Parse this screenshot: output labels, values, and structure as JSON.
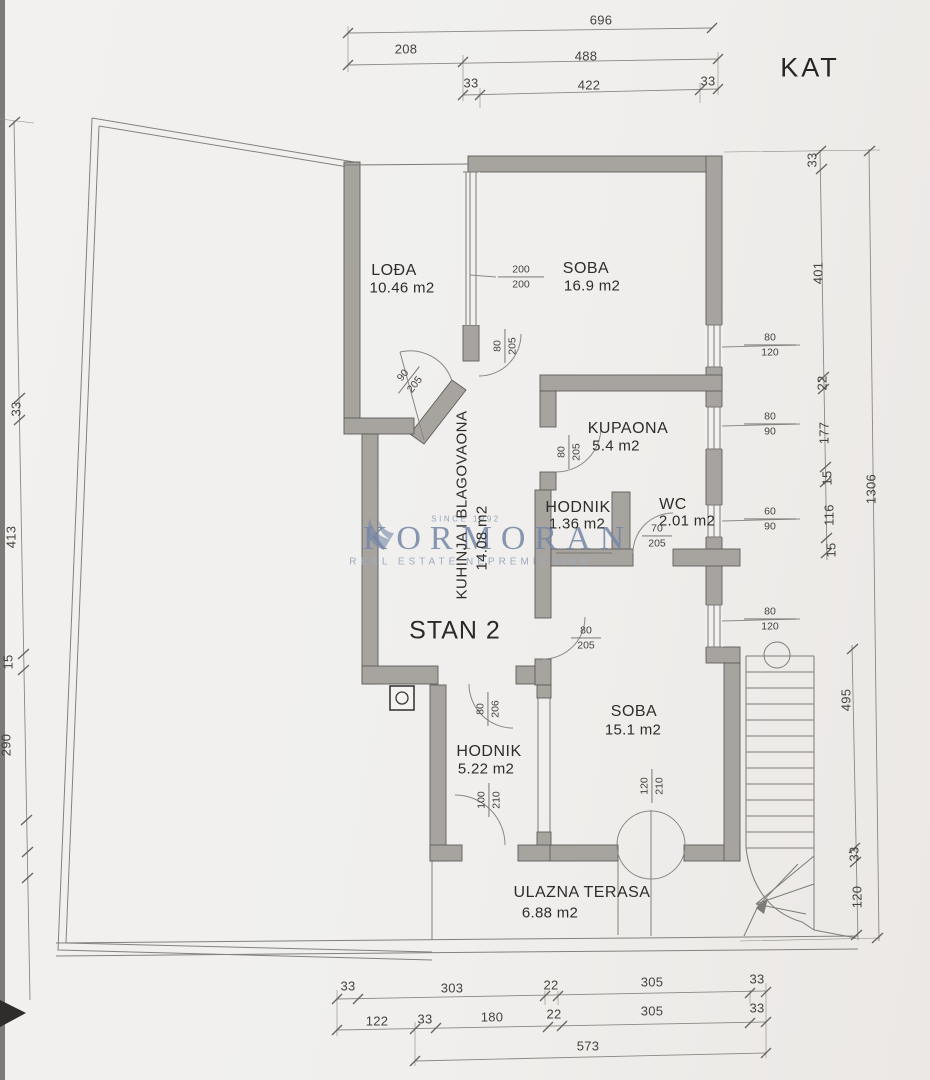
{
  "page": {
    "title": "KAT",
    "unit": "STAN 2"
  },
  "watermark": {
    "since": "SINCE 1992",
    "brand": "KORMORAN",
    "tagline": "REAL ESTATE NEPREMIČNINE"
  },
  "rooms": {
    "loda": {
      "name": "LOĐA",
      "area": "10.46 m2"
    },
    "soba1": {
      "name": "SOBA",
      "area": "16.9 m2"
    },
    "kupaona": {
      "name": "KUPAONA",
      "area": "5.4 m2"
    },
    "hodnik1": {
      "name": "HODNIK",
      "area": "1.36 m2"
    },
    "wc": {
      "name": "WC",
      "area": "2.01 m2"
    },
    "kuhinja": {
      "name": "KUHINJA I BLAGOVAONA",
      "area": "14.08 m2"
    },
    "hodnik2": {
      "name": "HODNIK",
      "area": "5.22 m2"
    },
    "soba2": {
      "name": "SOBA",
      "area": "15.1 m2"
    },
    "terasa": {
      "name": "ULAZNA TERASA",
      "area": "6.88 m2"
    }
  },
  "openings": {
    "win200": {
      "w": "200",
      "h": "200"
    },
    "win80120a": {
      "w": "80",
      "h": "120"
    },
    "win8090": {
      "w": "80",
      "h": "90"
    },
    "win6090": {
      "w": "60",
      "h": "90"
    },
    "win80120b": {
      "w": "80",
      "h": "120"
    },
    "door80205a": {
      "w": "80",
      "h": "205"
    },
    "door90205": {
      "w": "90",
      "h": "205"
    },
    "door80205b": {
      "w": "80",
      "h": "205"
    },
    "door80205c": {
      "w": "80",
      "h": "205"
    },
    "door70205": {
      "w": "70",
      "h": "205"
    },
    "door80206": {
      "w": "80",
      "h": "206"
    },
    "door100210": {
      "w": "100",
      "h": "210"
    },
    "door120210": {
      "w": "120",
      "h": "210"
    }
  },
  "dims": {
    "top": {
      "d696": "696",
      "d208": "208",
      "d488": "488",
      "d33a": "33",
      "d422": "422",
      "d33b": "33"
    },
    "right": {
      "d33a": "33",
      "d401": "401",
      "d22": "22",
      "d177": "177",
      "d15a": "15",
      "d116": "116",
      "d15b": "15",
      "d1306": "1306",
      "d495": "495",
      "d33b": "33",
      "d120": "120"
    },
    "left": {
      "d33": "33",
      "d413": "413",
      "d15": "15",
      "d290": "290"
    },
    "bottom": {
      "r1": [
        "33",
        "303",
        "22",
        "305",
        "33"
      ],
      "r2": [
        "122",
        "33",
        "180",
        "22",
        "305",
        "33"
      ],
      "r3": [
        "573"
      ]
    }
  },
  "colors": {
    "wall": "#a7a4a0",
    "line": "#7b7975",
    "paper": "#f0efed",
    "watermark": "#7487a6"
  }
}
